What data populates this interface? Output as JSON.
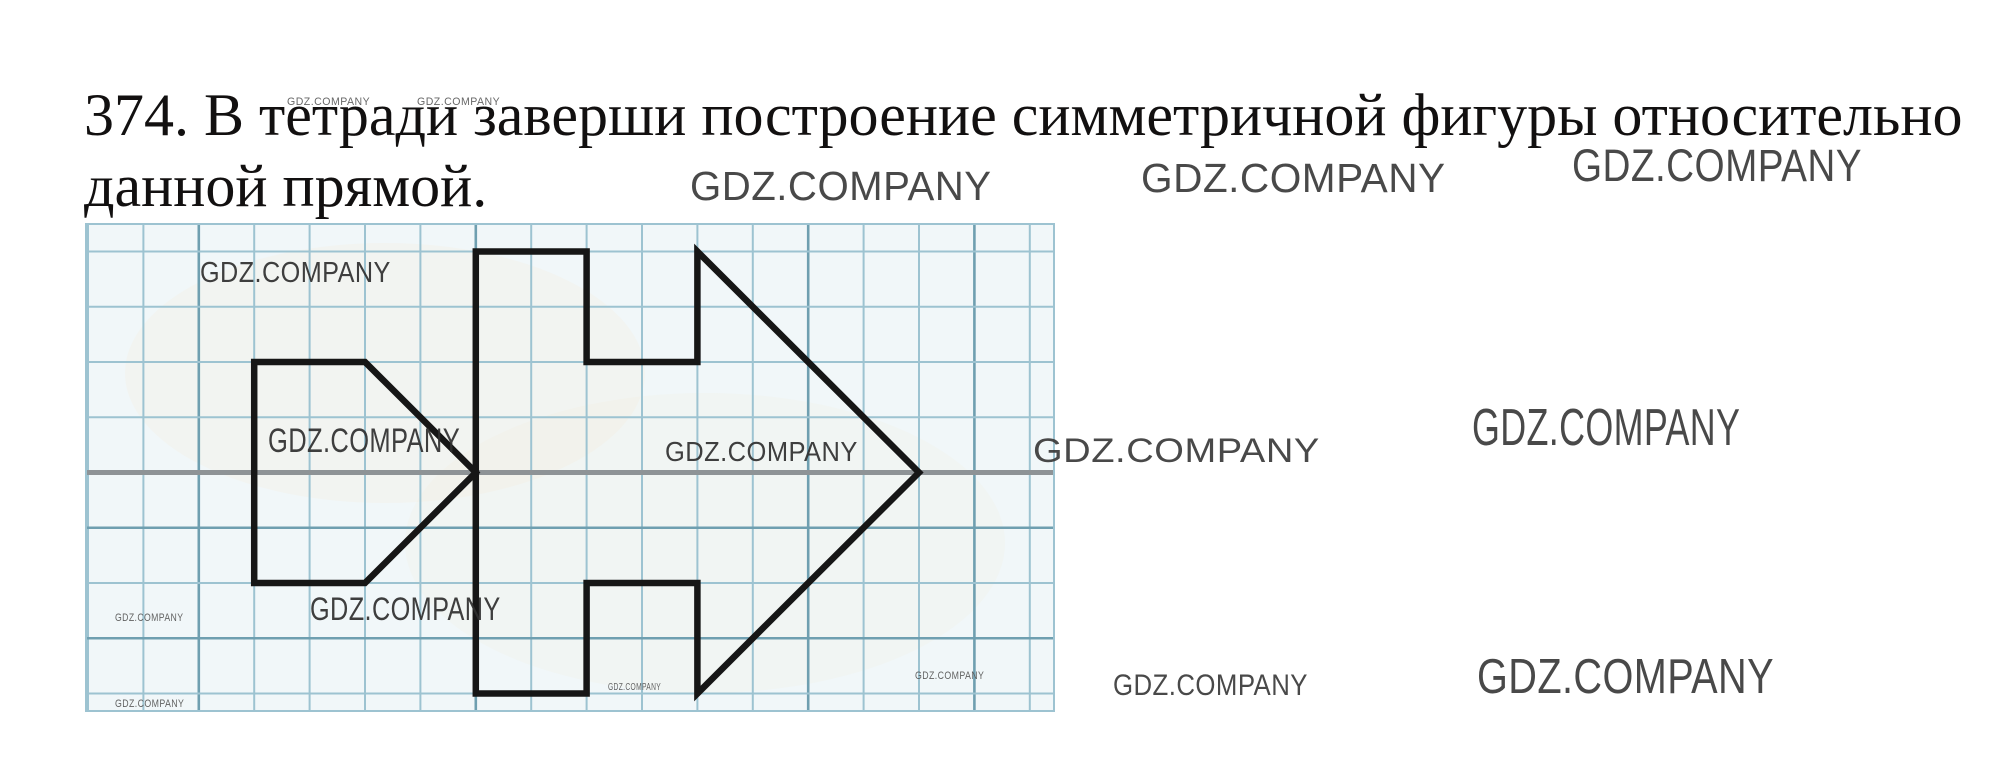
{
  "title": {
    "line1": "374. В тетради заверши построение симметричной фигуры относительно",
    "line2": "данной прямой."
  },
  "task_number": "374",
  "watermark": {
    "label": "GDZ.COMPANY"
  },
  "figure": {
    "description": "squared-notebook grid with a symmetric arrow figure and a pennant, mirrored about a horizontal axis line",
    "width": 970,
    "height": 489,
    "cell_w": 55.4,
    "cell_h": 55.25,
    "col0": 3,
    "row0": 28.5,
    "num_cols": 18,
    "num_rows": 9,
    "axis_row": 4,
    "dark_cols": [
      2,
      7,
      13,
      16
    ],
    "dark_rows": [
      5,
      7
    ],
    "arrow_outline": [
      [
        7,
        0
      ],
      [
        9,
        0
      ],
      [
        9,
        2
      ],
      [
        11,
        2
      ],
      [
        11,
        0
      ],
      [
        15,
        4
      ],
      [
        11,
        8
      ],
      [
        11,
        6
      ],
      [
        9,
        6
      ],
      [
        9,
        8
      ],
      [
        7,
        8
      ]
    ],
    "pennant_outline": [
      [
        3,
        2
      ],
      [
        5,
        2
      ],
      [
        7,
        4
      ],
      [
        5,
        6
      ],
      [
        3,
        6
      ]
    ],
    "colors": {
      "paper": "#f1f7f9",
      "grid": "#9dc3d1",
      "grid_dark": "#6f9fb0",
      "axis": "#8e9396",
      "figure": "#161616",
      "warm_patch": "#f5ecd6"
    }
  }
}
